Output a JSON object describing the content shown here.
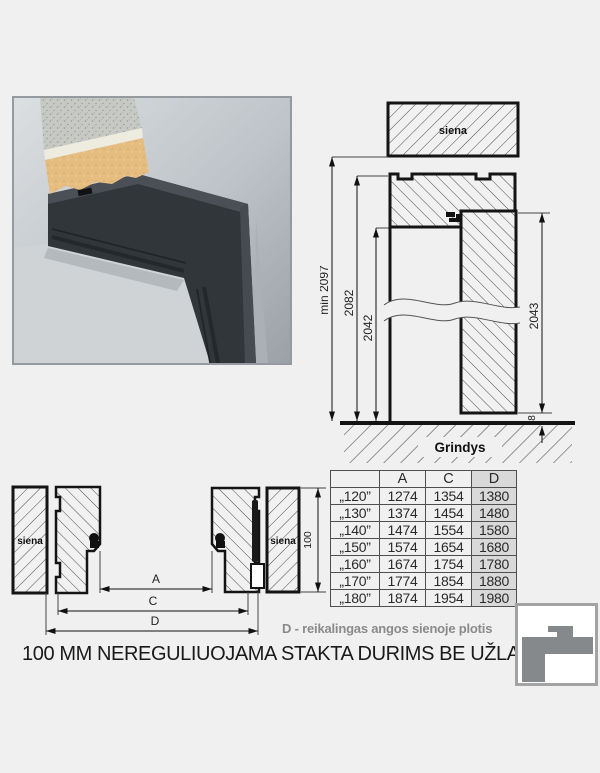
{
  "elevation": {
    "wall_label": "siena",
    "dim_total": "min 2097",
    "dim_frame": "2082",
    "dim_opening": "2042",
    "dim_leaf": "2043",
    "dim_gap": "8",
    "floor_label": "Grindys"
  },
  "plan": {
    "wall_label_left": "siena",
    "wall_label_right": "siena",
    "dim_a": "A",
    "dim_c": "C",
    "dim_d": "D",
    "dim_depth": "100"
  },
  "table": {
    "headers": [
      "",
      "A",
      "C",
      "D"
    ],
    "rows": [
      {
        "size": "„120”",
        "a": "1274",
        "c": "1354",
        "d": "1380"
      },
      {
        "size": "„130”",
        "a": "1374",
        "c": "1454",
        "d": "1480"
      },
      {
        "size": "„140”",
        "a": "1474",
        "c": "1554",
        "d": "1580"
      },
      {
        "size": "„150”",
        "a": "1574",
        "c": "1654",
        "d": "1680"
      },
      {
        "size": "„160”",
        "a": "1674",
        "c": "1754",
        "d": "1780"
      },
      {
        "size": "„170”",
        "a": "1774",
        "c": "1854",
        "d": "1880"
      },
      {
        "size": "„180”",
        "a": "1874",
        "c": "1954",
        "d": "1980"
      }
    ]
  },
  "note": "D - reikalingas angos sienoje plotis",
  "caption": "100 MM NEREGULIUOJAMA STAKTA DURIMS BE UŽLAIDOS",
  "colors": {
    "frame_dark": "#31363b",
    "wall_gray": "#b6bcc1",
    "wood_tan": "#e5bd80",
    "table_highlight": "#d9d9d9",
    "note_gray": "#8a8a8a",
    "line": "#141414",
    "background": "#f0f0f0"
  }
}
